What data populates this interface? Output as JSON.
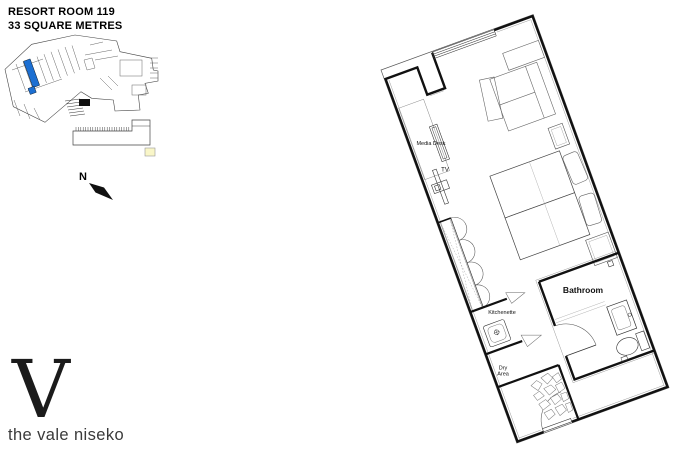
{
  "header": {
    "title_line1": "RESORT ROOM 119",
    "title_line2": "33 SQUARE METRES"
  },
  "key_map": {
    "highlight_color": "#1c6fd2",
    "legend_color": "#f9f6c8"
  },
  "compass": {
    "label": "N"
  },
  "floor_plan": {
    "labels": {
      "media_desk": "Media Desk",
      "tv": "TV",
      "kitchenette": "Kitchenette",
      "dry_line1": "Dry",
      "dry_line2": "Area",
      "bathroom": "Bathroom"
    }
  },
  "logo": {
    "monogram": "V",
    "wordmark": "the vale niseko"
  }
}
